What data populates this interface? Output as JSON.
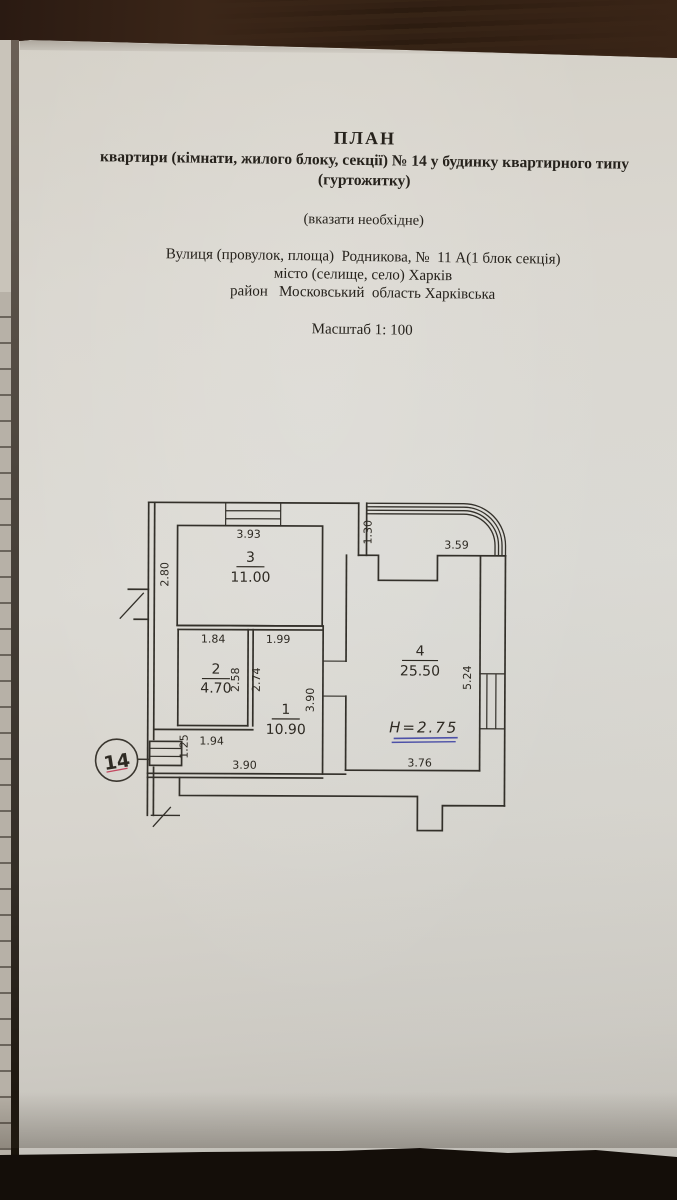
{
  "document": {
    "title": "ПЛАН",
    "subtitle": "квартири (кімнати, жилого блоку, секції) № 14 у будинку квартирного типу",
    "subtitle2": "(гуртожитку)",
    "note": "(вказати необхідне)",
    "street_line": "Вулиця (провулок, площа)  Родникова, №  11 А(1 блок секція)",
    "city_line": "місто (селище, село) Харків",
    "district_line": "район   Московський  область Харківська",
    "scale_line": "Масштаб 1: 100"
  },
  "plan": {
    "rooms": [
      {
        "number": "1",
        "area": "10.90"
      },
      {
        "number": "2",
        "area": "4.70"
      },
      {
        "number": "3",
        "area": "11.00"
      },
      {
        "number": "4",
        "area": "25.50"
      }
    ],
    "dims": {
      "room3_top": "3.93",
      "room3_left": "2.80",
      "room2_top": "1.84",
      "room1_top": "1.99",
      "room2_inner_right": "2.58",
      "room1_left": "2.74",
      "room2_bottom": "1.94",
      "entry_left": "1.25",
      "room1_right": "3.90",
      "room1_bottom": "3.90",
      "balcony_left": "1.30",
      "balcony_top": "3.59",
      "room4_right": "5.24",
      "room4_bottom": "3.76"
    },
    "height_note": "H=2.75",
    "apartment_stamp": "14",
    "colors": {
      "ink": "#2e2a23",
      "blue_pen": "#4d51a8",
      "red_pen": "#c2465e"
    }
  }
}
